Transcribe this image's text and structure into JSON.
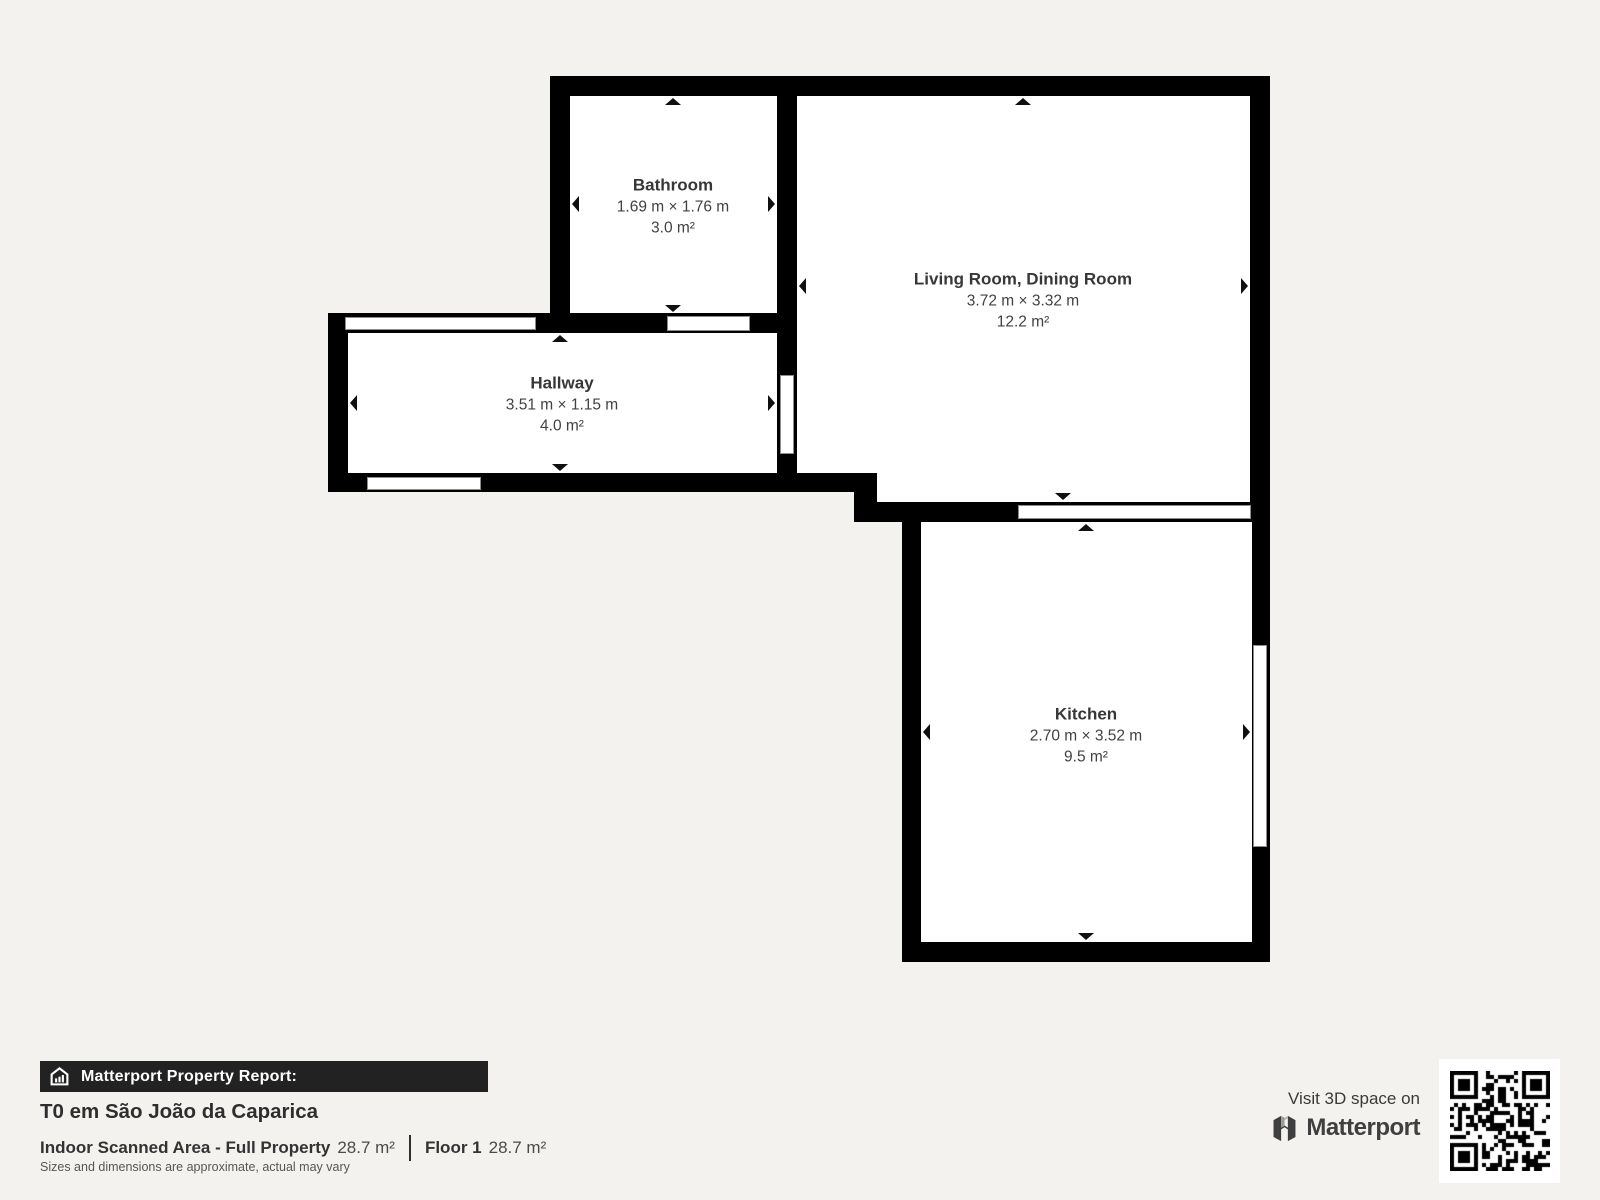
{
  "floorplan": {
    "wall_color": "#000000",
    "floor_color": "#ffffff",
    "rooms": [
      {
        "name": "Bathroom",
        "dimensions": "1.69 m × 1.76 m",
        "area": "3.0 m²"
      },
      {
        "name": "Living Room, Dining Room",
        "dimensions": "3.72 m × 3.32 m",
        "area": "12.2 m²"
      },
      {
        "name": "Hallway",
        "dimensions": "3.51 m × 1.15 m",
        "area": "4.0 m²"
      },
      {
        "name": "Kitchen",
        "dimensions": "2.70 m × 3.52 m",
        "area": "9.5 m²"
      }
    ]
  },
  "report": {
    "banner_label": "Matterport Property Report:",
    "title": "T0 em São João da Caparica",
    "indoor_area_label": "Indoor Scanned Area - Full Property",
    "indoor_area_value": "28.7 m²",
    "floor_label": "Floor 1",
    "floor_value": "28.7 m²",
    "disclaimer": "Sizes and dimensions are approximate, actual may vary"
  },
  "promo": {
    "visit_text": "Visit 3D space on",
    "brand": "Matterport"
  },
  "icons": {
    "banner_icon": "house-icon",
    "brand_icon": "matterport-logo-icon",
    "qr": "qr-code"
  }
}
